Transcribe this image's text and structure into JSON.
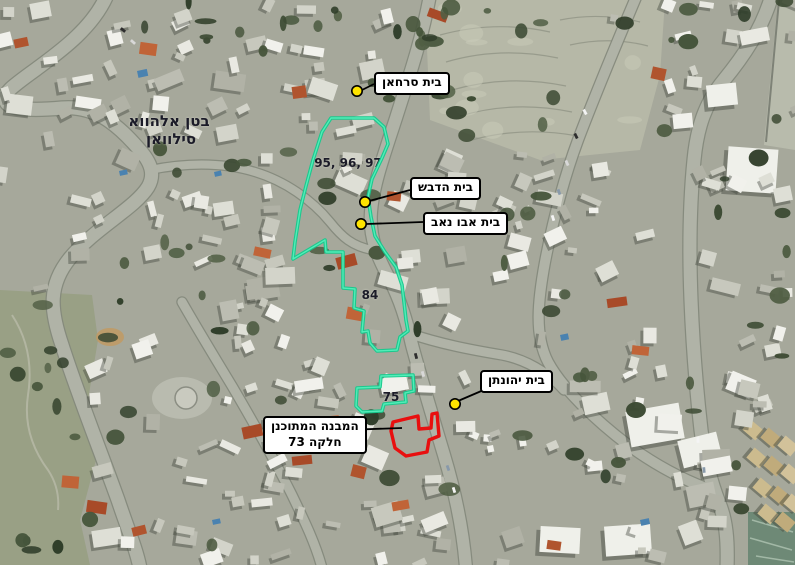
{
  "canvas": {
    "width": 795,
    "height": 565
  },
  "colors": {
    "parcel_outline": "#14c98c",
    "parcel_outline_sheen": "#5af0bd",
    "planned_outline": "#e80f0f",
    "marker_fill": "#ffe400",
    "marker_stroke": "#000000",
    "callout_bg": "#ffffff",
    "callout_border": "#000000",
    "leader_line": "#000000",
    "map_text": "#1b1b28"
  },
  "callouts": [
    {
      "id": "beit-sarhan",
      "text": "בית סרחאן",
      "box": {
        "x": 374,
        "y": 72
      },
      "leader": [
        [
          374,
          84
        ],
        [
          362,
          90
        ]
      ],
      "marker": {
        "x": 357,
        "y": 91
      }
    },
    {
      "id": "beit-hadvash",
      "text": "בית הדבש",
      "box": {
        "x": 410,
        "y": 177
      },
      "leader": [
        [
          410,
          190
        ],
        [
          369,
          201
        ]
      ],
      "marker": {
        "x": 365,
        "y": 202
      }
    },
    {
      "id": "beit-abu-nab",
      "text": "בית אבו נאב",
      "box": {
        "x": 423,
        "y": 212
      },
      "leader": [
        [
          423,
          222
        ],
        [
          366,
          224
        ]
      ],
      "marker": {
        "x": 361,
        "y": 224
      }
    },
    {
      "id": "beit-yehonatan",
      "text": "בית יהונתן",
      "box": {
        "x": 480,
        "y": 370
      },
      "leader": [
        [
          486,
          389
        ],
        [
          458,
          401
        ]
      ],
      "marker": {
        "x": 455,
        "y": 404
      }
    },
    {
      "id": "planned-structure",
      "lines": [
        "המבנה המתוכנן",
        "חלקה 73"
      ],
      "box": {
        "x": 263,
        "y": 416
      },
      "leader": [
        [
          344,
          430
        ],
        [
          402,
          428
        ]
      ]
    }
  ],
  "map_texts": [
    {
      "id": "batn-al-hawa",
      "text": "בטן אלהווא",
      "x": 169,
      "y": 121,
      "size": 15
    },
    {
      "id": "silwan",
      "text": "סילוואן",
      "x": 171,
      "y": 139,
      "size": 15
    },
    {
      "id": "parcels-95-96-97",
      "text": "95, 96, 97",
      "x": 348,
      "y": 163,
      "size": 12
    },
    {
      "id": "parcel-84",
      "text": "84",
      "x": 370,
      "y": 295,
      "size": 12
    },
    {
      "id": "parcel-75",
      "text": "75",
      "x": 391,
      "y": 397,
      "size": 12
    }
  ],
  "parcels": [
    {
      "id": "parcel-group-95-96-97-84",
      "kind": "existing",
      "points": [
        [
          331,
          118
        ],
        [
          374,
          118
        ],
        [
          384,
          127
        ],
        [
          388,
          144
        ],
        [
          382,
          158
        ],
        [
          372,
          179
        ],
        [
          368,
          197
        ],
        [
          371,
          217
        ],
        [
          375,
          236
        ],
        [
          385,
          252
        ],
        [
          396,
          267
        ],
        [
          402,
          285
        ],
        [
          404,
          302
        ],
        [
          406,
          320
        ],
        [
          408,
          331
        ],
        [
          400,
          337
        ],
        [
          397,
          350
        ],
        [
          377,
          351
        ],
        [
          370,
          343
        ],
        [
          368,
          331
        ],
        [
          362,
          332
        ],
        [
          364,
          311
        ],
        [
          354,
          308
        ],
        [
          355,
          289
        ],
        [
          343,
          288
        ],
        [
          343,
          252
        ],
        [
          326,
          252
        ],
        [
          325,
          240
        ],
        [
          293,
          259
        ],
        [
          295,
          242
        ],
        [
          300,
          210
        ],
        [
          306,
          186
        ],
        [
          313,
          160
        ],
        [
          322,
          132
        ]
      ]
    },
    {
      "id": "parcel-75-outline",
      "kind": "existing",
      "points": [
        [
          381,
          376
        ],
        [
          413,
          375
        ],
        [
          414,
          391
        ],
        [
          405,
          393
        ],
        [
          406,
          402
        ],
        [
          384,
          404
        ],
        [
          382,
          411
        ],
        [
          362,
          412
        ],
        [
          356,
          406
        ],
        [
          357,
          388
        ],
        [
          380,
          387
        ]
      ]
    },
    {
      "id": "planned-building-plot-73",
      "kind": "planned",
      "points": [
        [
          393,
          422
        ],
        [
          418,
          416
        ],
        [
          419,
          429
        ],
        [
          431,
          428
        ],
        [
          432,
          414
        ],
        [
          437,
          413
        ],
        [
          439,
          436
        ],
        [
          429,
          440
        ],
        [
          427,
          452
        ],
        [
          406,
          456
        ],
        [
          395,
          448
        ],
        [
          391,
          431
        ]
      ]
    }
  ]
}
